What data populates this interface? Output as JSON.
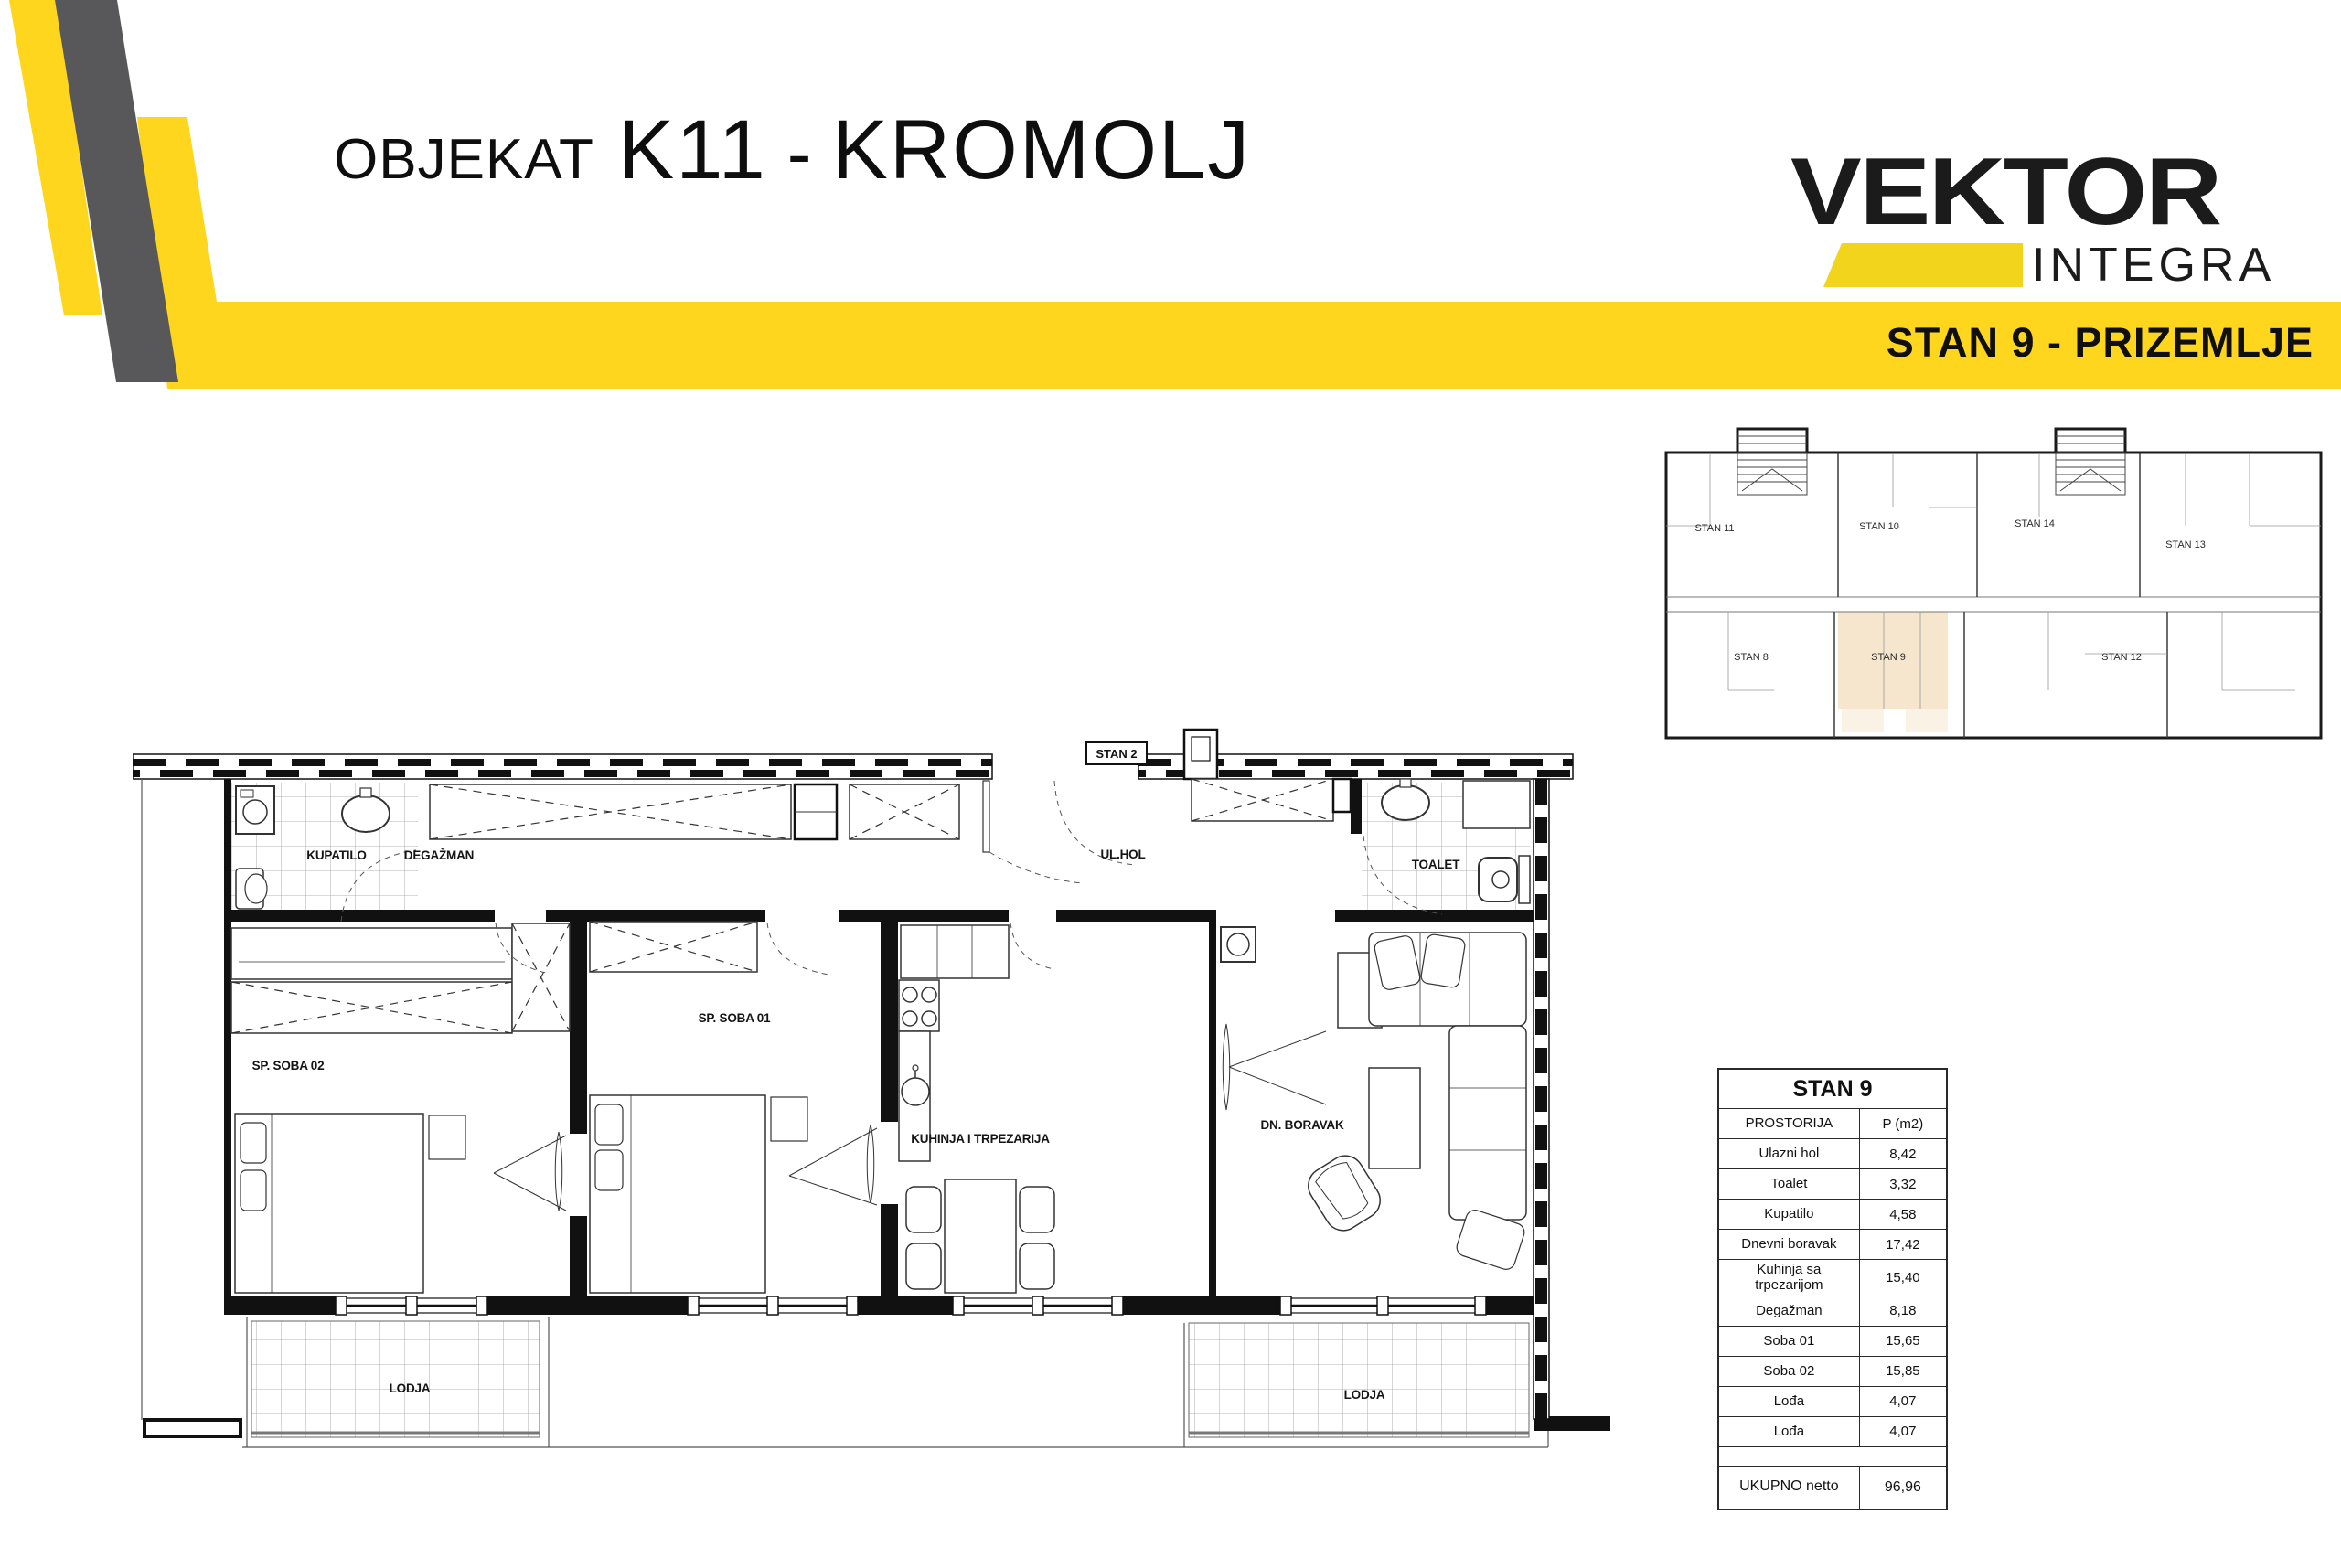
{
  "header": {
    "title": {
      "prefix": "OBJEKAT",
      "code": "K11",
      "separator": "-",
      "name": "KROMOLJ"
    },
    "logo": {
      "brand": "VEKTOR",
      "sub": "INTEGRA"
    },
    "banner": {
      "label": "STAN 9 - PRIZEMLJE"
    }
  },
  "colors": {
    "accent_yellow": "#FFD61E",
    "band_gray": "#58585A",
    "highlight_beige": "#F5E6CD",
    "highlight_beige_light": "#FAF2E4",
    "ink": "#1A1A1A"
  },
  "overview_plan": {
    "highlighted_unit": "STAN 9",
    "units": [
      {
        "label": "STAN 11"
      },
      {
        "label": "STAN 10"
      },
      {
        "label": "STAN 14"
      },
      {
        "label": "STAN 13"
      },
      {
        "label": "STAN 8"
      },
      {
        "label": "STAN 9"
      },
      {
        "label": "STAN 12"
      }
    ]
  },
  "floor_plan": {
    "neighbor_label": "STAN 2",
    "rooms": {
      "kupatilo": "KUPATILO",
      "degazman": "DEGAŽMAN",
      "ulhol": "UL.HOL",
      "toalet": "TOALET",
      "soba02": "SP. SOBA 02",
      "soba01": "SP. SOBA 01",
      "kuhinja": "KUHINJA I TRPEZARIJA",
      "boravak": "DN. BORAVAK",
      "lodja_left": "LODJA",
      "lodja_right": "LODJA"
    }
  },
  "area_table": {
    "title": "STAN 9",
    "columns": {
      "room": "PROSTORIJA",
      "area": "P (m2)"
    },
    "rows": [
      {
        "room": "Ulazni hol",
        "area": "8,42"
      },
      {
        "room": "Toalet",
        "area": "3,32"
      },
      {
        "room": "Kupatilo",
        "area": "4,58"
      },
      {
        "room": "Dnevni boravak",
        "area": "17,42"
      },
      {
        "room": "Kuhinja sa trpezarijom",
        "area": "15,40"
      },
      {
        "room": "Degažman",
        "area": "8,18"
      },
      {
        "room": "Soba 01",
        "area": "15,65"
      },
      {
        "room": "Soba 02",
        "area": "15,85"
      },
      {
        "room": "Lođa",
        "area": "4,07"
      },
      {
        "room": "Lođa",
        "area": "4,07"
      }
    ],
    "total": {
      "label": "UKUPNO netto",
      "value": "96,96"
    }
  }
}
